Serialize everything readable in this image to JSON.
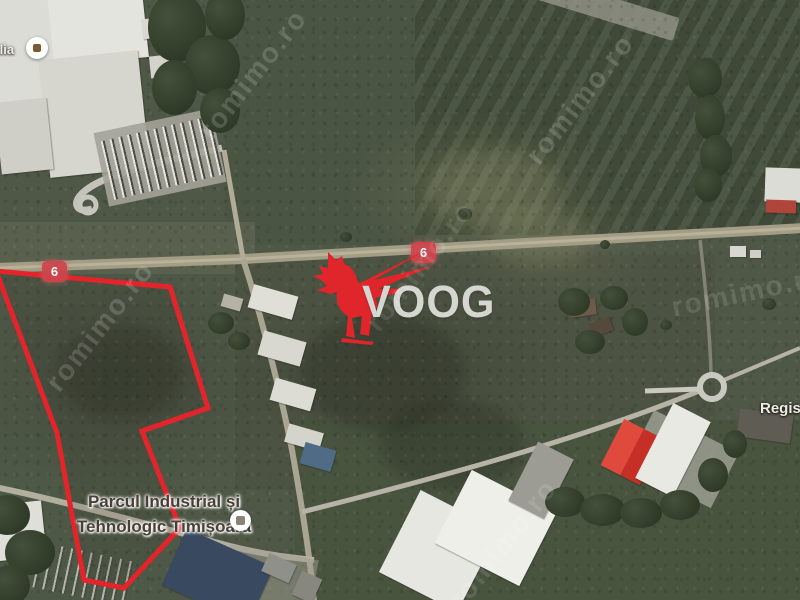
{
  "map": {
    "kind": "satellite-aerial-view",
    "colors": {
      "parcel_outline_red": "#e3242b",
      "route_badge_red": "#ce444c",
      "logo_red": "#e0252b",
      "logo_gray": "#d6d6d1",
      "label_dark": "#4a3f36",
      "field_green": "#4c5342",
      "road_tan": "#a39d85"
    },
    "route_badges": [
      {
        "number": "6"
      },
      {
        "number": "6"
      }
    ],
    "labels": {
      "industrial_park_line1": "Parcul Industrial și",
      "industrial_park_line2": "Tehnologic Timișoara",
      "left_edge_partial": "ilia",
      "right_edge_partial": "Regis"
    },
    "watermark": {
      "logo_text": "VOOG",
      "logo_icon": "griffin-icon",
      "tile_text": "romimo.ro"
    }
  }
}
